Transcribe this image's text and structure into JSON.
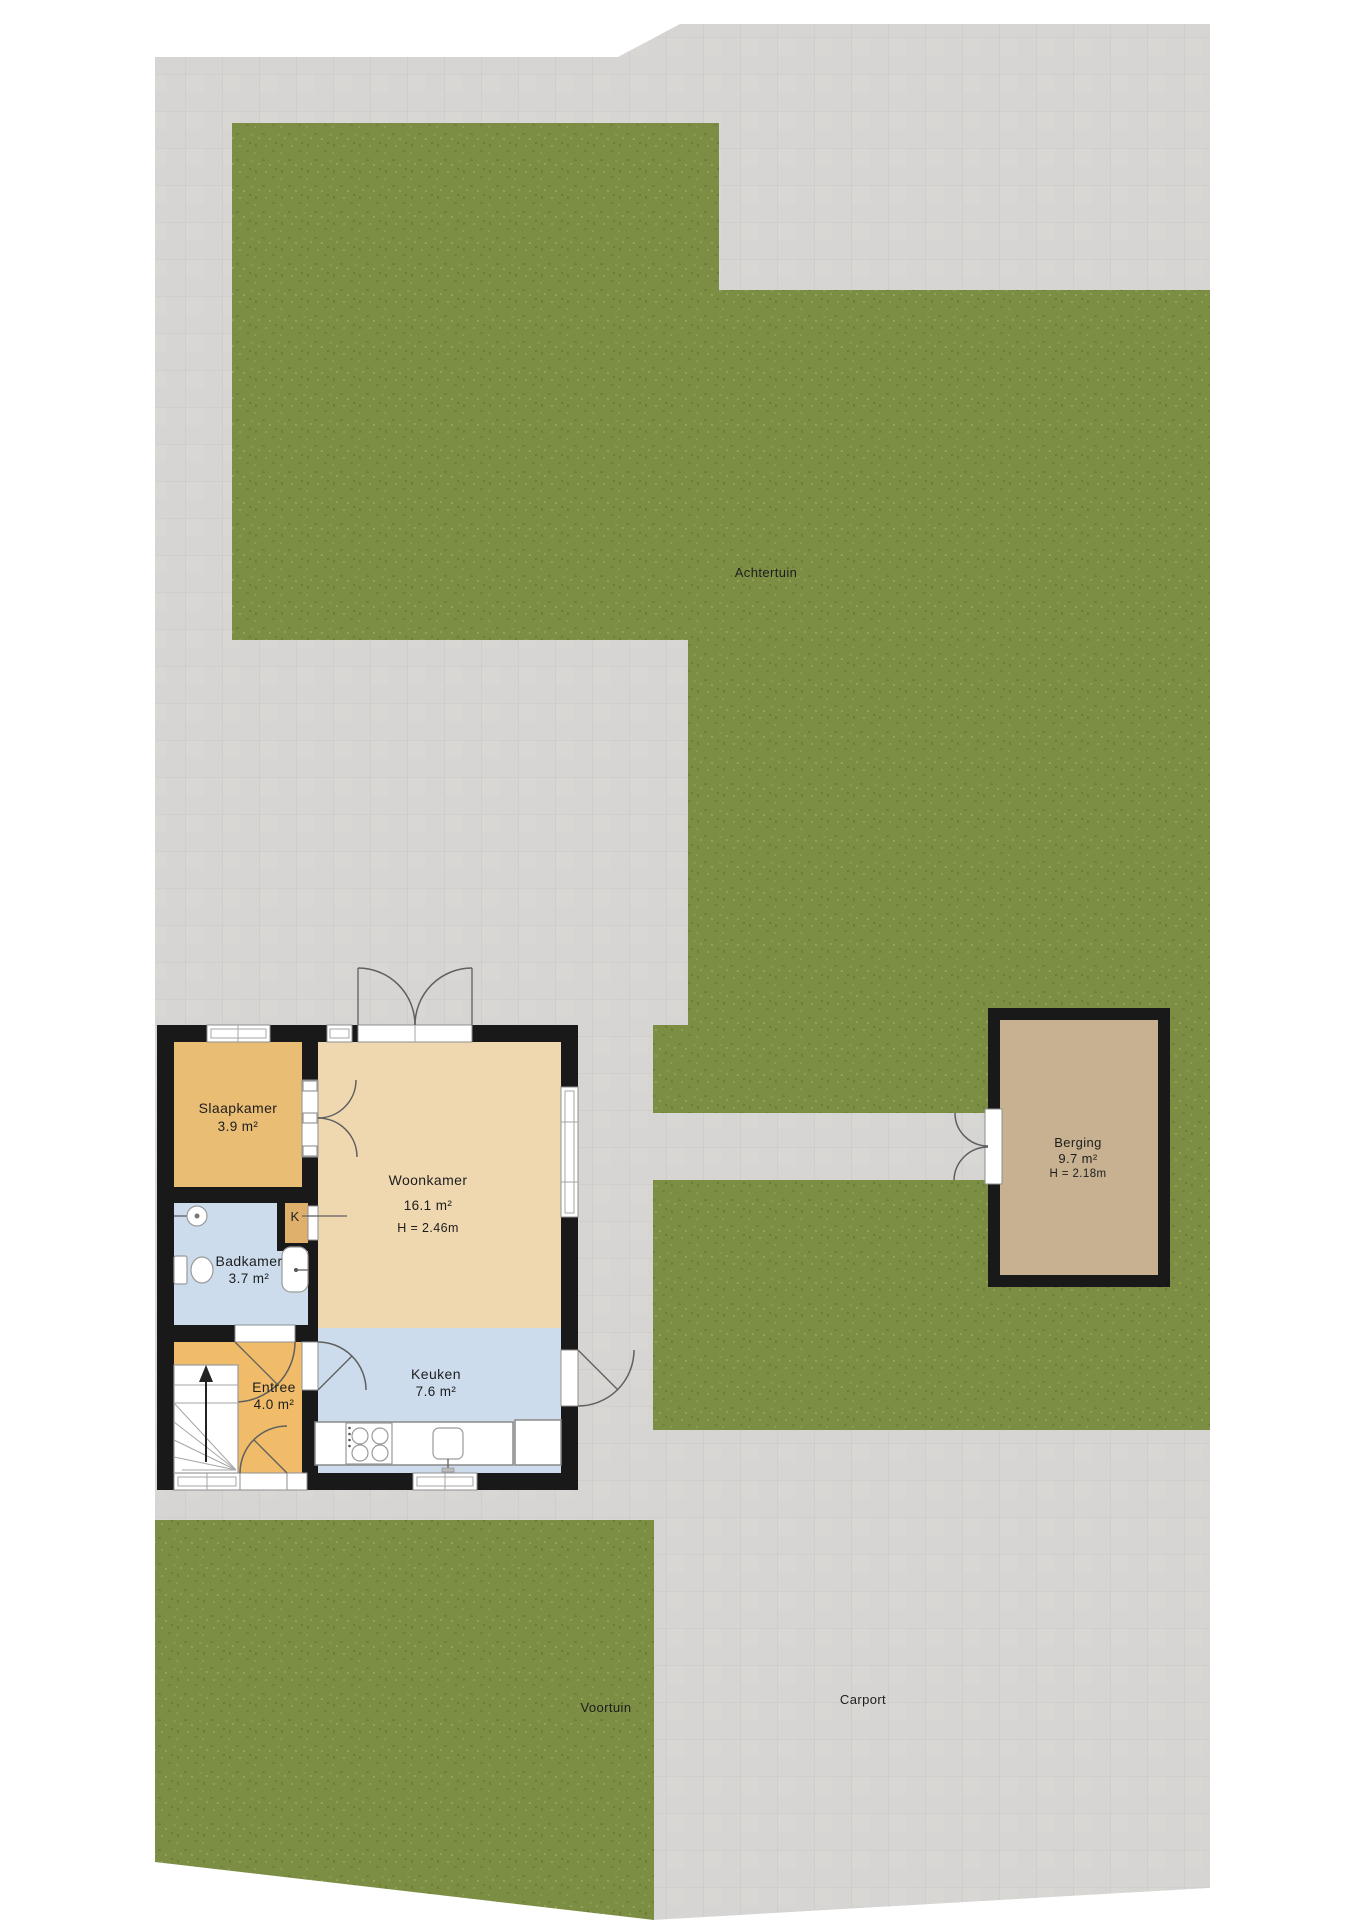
{
  "document_type": "floor-plan",
  "site": {
    "labels": {
      "achtertuin": "Achtertuin",
      "voortuin": "Voortuin",
      "carport": "Carport"
    }
  },
  "rooms": {
    "slaapkamer": {
      "label": "Slaapkamer",
      "area": "3.9 m²"
    },
    "woonkamer": {
      "label": "Woonkamer",
      "area": "16.1 m²",
      "height": "H = 2.46m"
    },
    "badkamer": {
      "label": "Badkamer",
      "area": "3.7 m²"
    },
    "kast": {
      "label": "K"
    },
    "entree": {
      "label": "Entree",
      "area": "4.0 m²"
    },
    "keuken": {
      "label": "Keuken",
      "area": "7.6 m²"
    },
    "berging": {
      "label": "Berging",
      "area": "9.7 m²",
      "height": "H = 2.18m"
    }
  },
  "colors": {
    "grass": "#7c8e43",
    "paving": "#d6d5d3",
    "paving_grid": "#c9c8c6",
    "wall": "#191919",
    "living_floor": "#efd8b0",
    "bedroom_floor": "#eabd74",
    "entry_floor": "#f0bc69",
    "wet_room_floor": "#ccdcec",
    "shed_floor": "#c8b190",
    "label_text": "#1d1d1d",
    "background": "#ffffff"
  }
}
